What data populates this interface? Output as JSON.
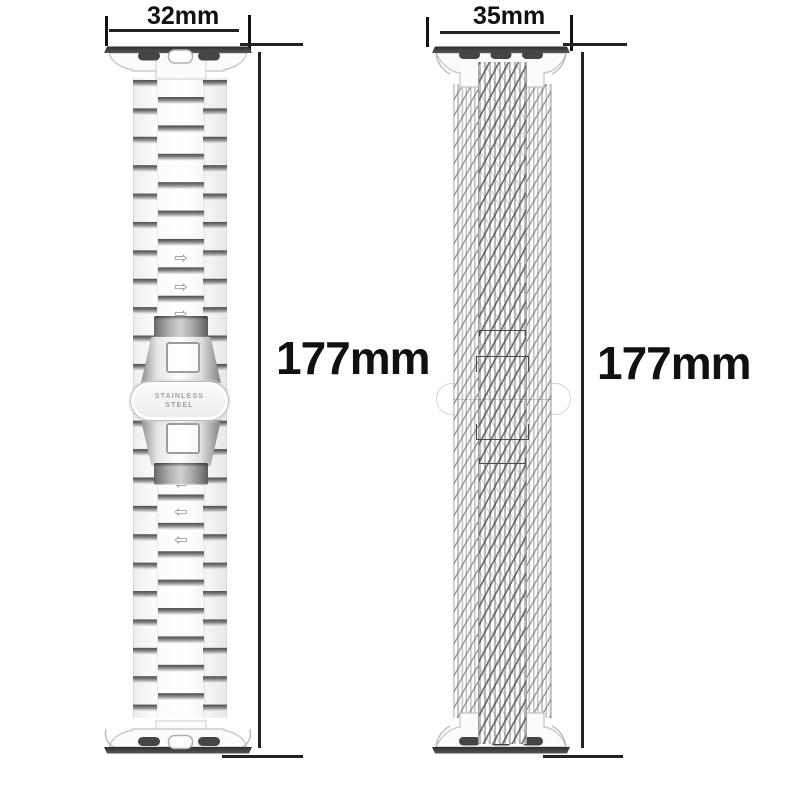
{
  "canvas": {
    "background": "#ffffff"
  },
  "left_band": {
    "type": "stainless-steel-link-bracelet",
    "width_label": "32mm",
    "length_label": "177mm",
    "clasp": {
      "line1": "STAINLESS",
      "line2": "STEEL"
    },
    "arrows": {
      "upper_char": "⇨",
      "lower_char": "⇦",
      "upper_count": 3,
      "lower_count": 3
    }
  },
  "right_band": {
    "type": "milanese-mesh-loop",
    "width_label": "35mm",
    "length_label": "177mm"
  },
  "colors": {
    "dimension_line": "#222222",
    "label_text": "#111111",
    "metal_dark": "#3b3b3b",
    "metal_mid": "#8d8d8d",
    "metal_light": "#f5f5f5"
  }
}
